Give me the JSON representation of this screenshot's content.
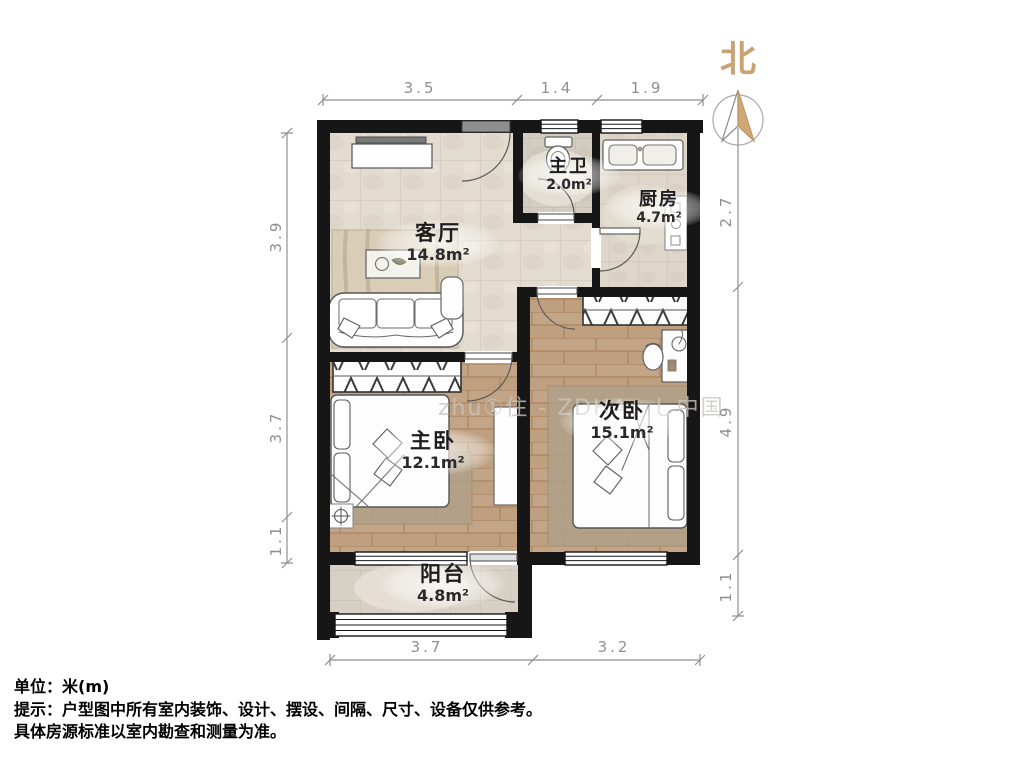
{
  "north": {
    "label": "北"
  },
  "rooms": {
    "living": {
      "name": "客厅",
      "area": "14.8m²"
    },
    "master_bath": {
      "name": "主卫",
      "area": "2.0m²"
    },
    "kitchen": {
      "name": "厨房",
      "area": "4.7m²"
    },
    "master_bedroom": {
      "name": "主卧",
      "area": "12.1m²"
    },
    "second_bedroom": {
      "name": "次卧",
      "area": "15.1m²"
    },
    "balcony": {
      "name": "阳台",
      "area": "4.8m²"
    }
  },
  "dimensions": {
    "top": [
      "3.5",
      "1.4",
      "1.9"
    ],
    "left": [
      "3.9",
      "3.7",
      "1.1"
    ],
    "right": [
      "2.7",
      "4.9",
      "1.1"
    ],
    "bottom": [
      "3.7",
      "3.2"
    ]
  },
  "notes": {
    "unit": "单位：米(m)",
    "tip1": "提示：户型图中所有室内装饰、设计、摆设、间隔、尺寸、设备仅供参考。",
    "tip2": "具体房源标准以室内勘查和测量为准。"
  },
  "watermark": "zhu①住 - ZDHA　し中国",
  "colors": {
    "wall": "#161616",
    "dimension": "#8f8f8f",
    "north_accent": "#c8a376",
    "wood_floor": "#c2a486",
    "tile_floor": "#e2dbcf"
  }
}
